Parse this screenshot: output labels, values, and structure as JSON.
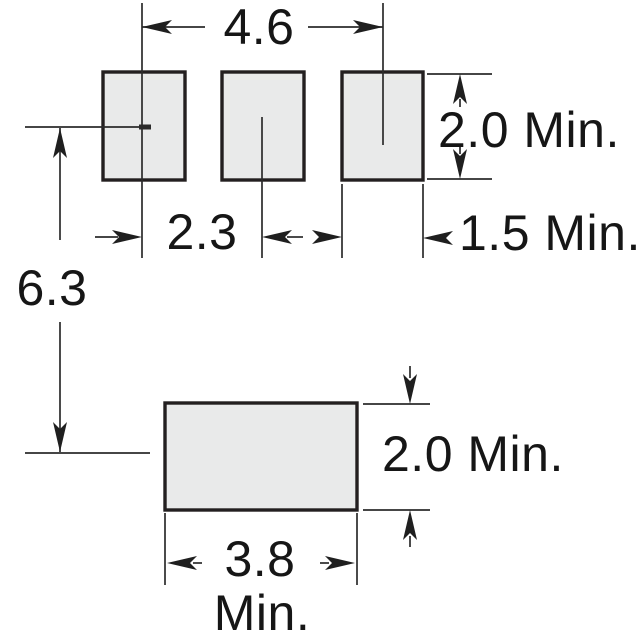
{
  "diagram": {
    "top_row": {
      "overall_pitch": "4.6",
      "pad_pitch": "2.3",
      "pad_width": "1.5 Min.",
      "pad_height": "2.0 Min."
    },
    "row_spacing": "6.3",
    "bottom_pad": {
      "height": "2.0 Min.",
      "width_value": "3.8",
      "width_unit": "Min."
    },
    "colors": {
      "line": "#2b2b2b",
      "pad_fill": "#e9eaea",
      "pad_border": "#231f20",
      "text": "#161616",
      "background": "#ffffff"
    }
  }
}
